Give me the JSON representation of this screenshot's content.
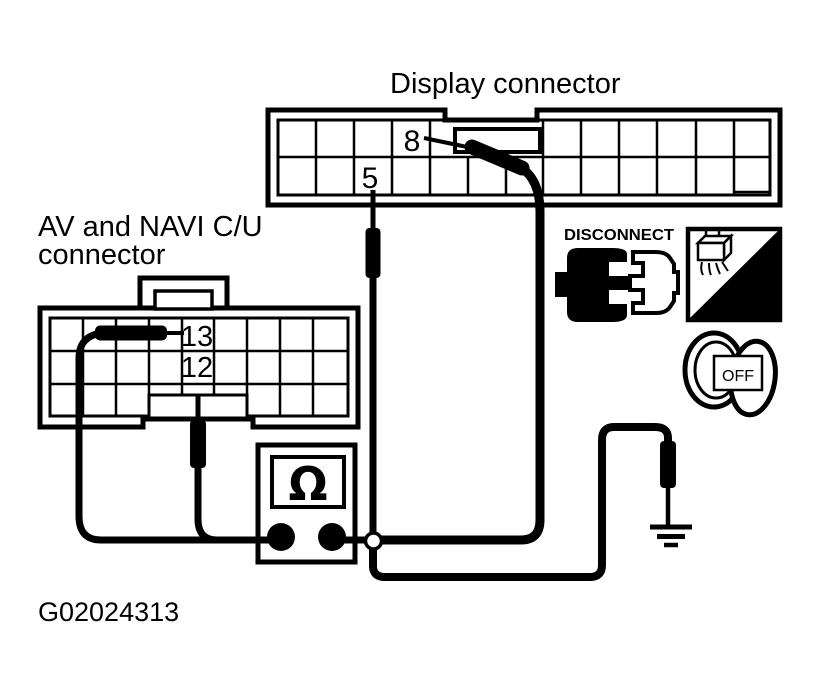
{
  "figure": {
    "id": "G02024313"
  },
  "display_connector": {
    "label": "Display connector",
    "pins": {
      "pin8": "8",
      "pin5": "5"
    }
  },
  "av_navi_connector": {
    "label_line1": "AV and NAVI C/U",
    "label_line2": "connector",
    "pins": {
      "pin13": "13",
      "pin12": "12"
    }
  },
  "ohmmeter": {
    "symbol": "Ω"
  },
  "badges": {
    "disconnect": {
      "label": "DISCONNECT"
    },
    "hand_scope": {
      "label": "H.S."
    },
    "ignition_key": {
      "label": "OFF"
    }
  },
  "colors": {
    "ink": "#000000",
    "background": "#ffffff"
  }
}
